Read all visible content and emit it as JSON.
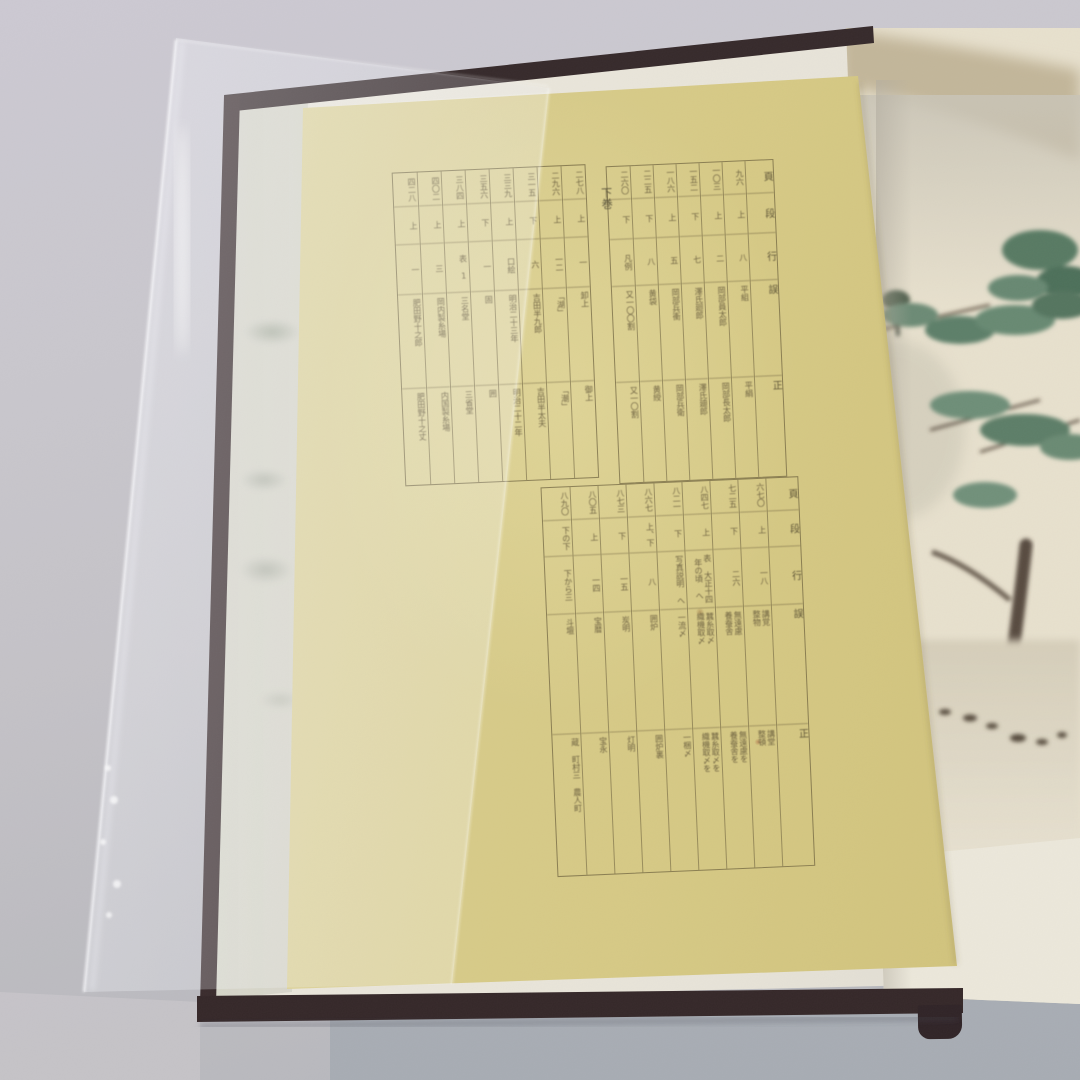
{
  "sheet": {
    "volume_label": "下巻",
    "column_headers": [
      "頁",
      "段",
      "行",
      "誤",
      "正"
    ],
    "upper_right_table": {
      "entries": [
        {
          "page": "九六",
          "dan": "上",
          "line": "八",
          "wrong": "平組",
          "correct": "平絹"
        },
        {
          "page": "一〇三",
          "dan": "上",
          "line": "二",
          "wrong": "岡部員太郎",
          "correct": "岡部長太郎"
        },
        {
          "page": "一五二",
          "dan": "下",
          "line": "七",
          "wrong": "澤氏廻郎",
          "correct": "澤氏廸郎"
        },
        {
          "page": "一八六",
          "dan": "上",
          "line": "五",
          "wrong": "岡部兵衝",
          "correct": "岡部兵衛"
        },
        {
          "page": "二二五",
          "dan": "下",
          "line": "八",
          "wrong": "黄袋",
          "correct": "黄綬"
        },
        {
          "page": "二六〇",
          "dan": "下",
          "line": "凡例",
          "wrong": "又一〇〇割",
          "correct": "又一〇割"
        }
      ]
    },
    "upper_left_table": {
      "entries": [
        {
          "page": "二七八",
          "dan": "上",
          "line": "一",
          "wrong": "卸上",
          "correct": "御上"
        },
        {
          "page": "二九六",
          "dan": "上",
          "line": "一二",
          "wrong": "「湖」",
          "correct": "「潮」"
        },
        {
          "page": "三一五",
          "dan": "下",
          "line": "六",
          "wrong": "吉田半九郎",
          "correct": "吉田半太夫"
        },
        {
          "page": "三三九",
          "dan": "上",
          "line": "口絵",
          "wrong": "明治二十三年",
          "correct": "明治二十二年"
        },
        {
          "page": "三五六",
          "dan": "下",
          "line": "一",
          "wrong": "固",
          "correct": "囲"
        },
        {
          "page": "三八四",
          "dan": "上",
          "line": "表 1",
          "wrong": "三名堂",
          "correct": "三省堂"
        },
        {
          "page": "四〇二",
          "dan": "上",
          "line": "三",
          "wrong": "岡内製糸場",
          "correct": "内国製糸場"
        },
        {
          "page": "四二八",
          "dan": "上",
          "line": "一",
          "wrong": "肥田野十之郎",
          "correct": "肥田野十之丈"
        }
      ]
    },
    "lower_table": {
      "entries": [
        {
          "page": "六七〇",
          "dan": "上",
          "line": "一八",
          "wrong": "講覚\n整物",
          "correct": "講堂\n整頓"
        },
        {
          "page": "七二五",
          "dan": "下",
          "line": "二六",
          "wrong": "無遠慮\n養蚕舎",
          "correct": "無遠慮を\n養蚕舎を"
        },
        {
          "page": "八四七",
          "dan": "上",
          "line": "表 大正十四年の頃 へ",
          "wrong": "蠶糸取〆\n織機取〆",
          "correct": "蠶糸取〆を\n織機取〆を"
        },
        {
          "page": "八二一",
          "dan": "下",
          "line": "写真説明 へ",
          "wrong": "一流〆",
          "correct": "一梱〆"
        },
        {
          "page": "八六七",
          "dan": "上、下",
          "line": "八",
          "wrong": "囲炉",
          "correct": "囲炉裏"
        },
        {
          "page": "八七三",
          "dan": "下",
          "line": "一五",
          "wrong": "炭明",
          "correct": "灯明"
        },
        {
          "page": "八〇五",
          "dan": "上",
          "line": "一四",
          "wrong": "宝暦",
          "correct": "宝永"
        },
        {
          "page": "八九〇",
          "dan": "下の下",
          "line": "下から三",
          "wrong": "斗壇",
          "correct": "蔵 町村三 農人町"
        }
      ]
    }
  },
  "palette": {
    "sheet_yellow": "#d7cb8a",
    "book_cover": "#362a2b",
    "page_cream": "#e7e0cd",
    "surface_gray": "#c6c4cb",
    "pine_green": "#5d7f69",
    "branch_brown": "#4a3d30",
    "ink": "#55492f"
  }
}
